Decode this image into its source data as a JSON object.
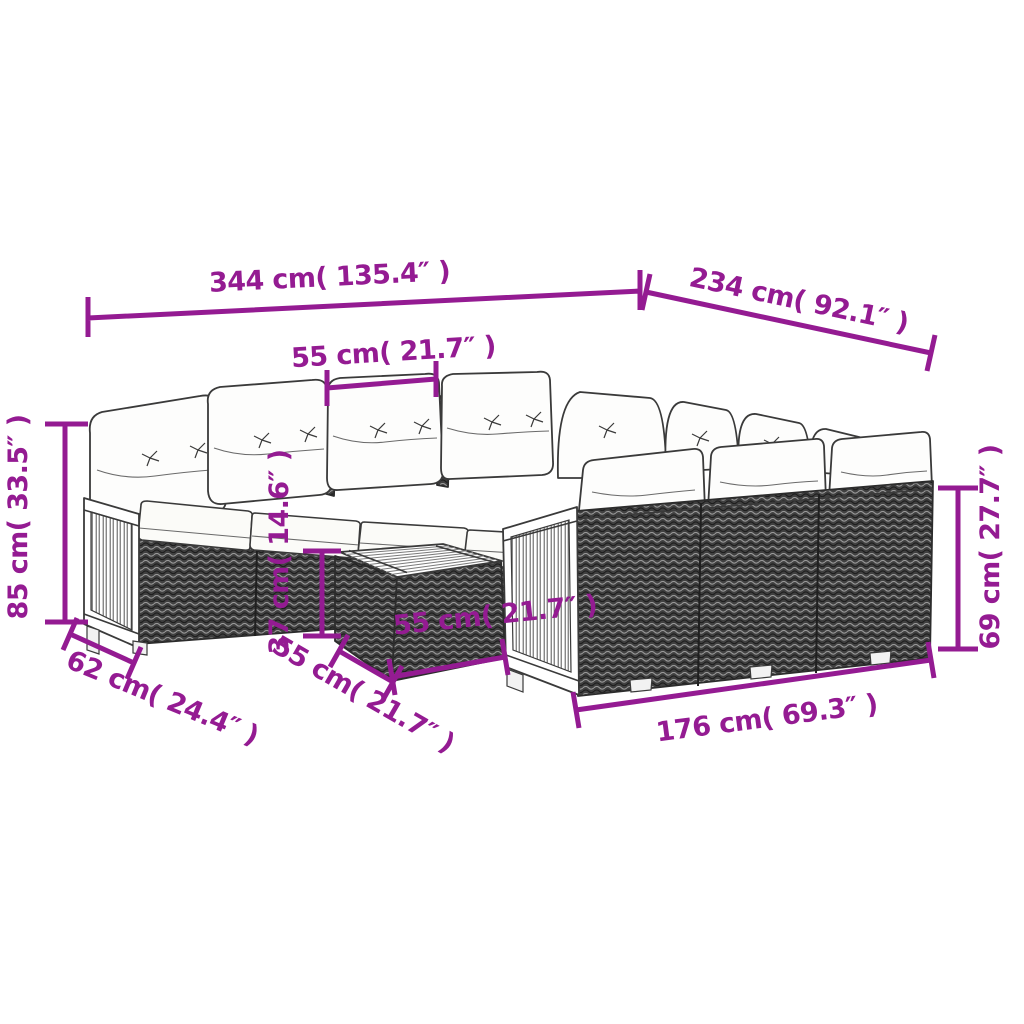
{
  "diagram": {
    "kind": "furniture-dimension-diagram",
    "colors": {
      "accent": "#941b92",
      "line_art": "#3a3a3a",
      "background": "#ffffff"
    }
  },
  "dimensions": {
    "overall_width": {
      "label": "344 cm( 135.4″ )"
    },
    "overall_depth": {
      "label": "234 cm( 92.1″ )"
    },
    "seat_width": {
      "label": "55 cm( 21.7″ )"
    },
    "overall_height": {
      "label": "85 cm( 33.5″ )"
    },
    "armrest_depth": {
      "label": "62 cm( 24.4″ )"
    },
    "table_height": {
      "label": "37 cm( 14.6″ )"
    },
    "table_depth": {
      "label": "55 cm( 21.7″ )"
    },
    "table_width": {
      "label": "55 cm( 21.7″ )"
    },
    "back_height": {
      "label": "69 cm( 27.7″ )"
    },
    "right_section_width": {
      "label": "176 cm( 69.3″ )"
    }
  }
}
